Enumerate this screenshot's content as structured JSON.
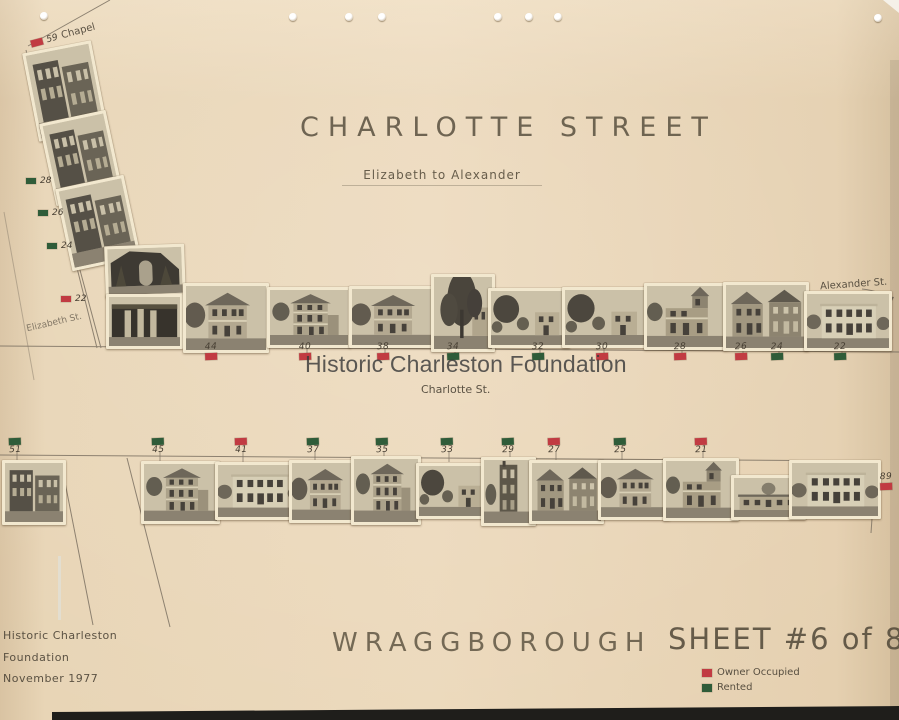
{
  "document": {
    "kind": "scanned street survey sheet",
    "title": "CHARLOTTE STREET",
    "subtitle": "Elizabeth to Alexander",
    "watermark": "Historic Charleston Foundation",
    "street_caption": "Charlotte St.",
    "neighborhood": "WRAGGBOROUGH",
    "sheet_label": "SHEET #6 of 8"
  },
  "status_colors": {
    "owner": "#c13b42",
    "rented": "#2f5c39"
  },
  "corner_label": {
    "number": "59",
    "street": "Chapel",
    "status": "owner"
  },
  "side_streets": {
    "left": "Elizabeth St.",
    "right": "Alexander St."
  },
  "left_strip_markers": [
    {
      "number": "28",
      "status": "rented"
    },
    {
      "number": "26",
      "status": "rented"
    },
    {
      "number": "24",
      "status": "rented"
    },
    {
      "number": "22",
      "status": "owner"
    }
  ],
  "top_row": [
    {
      "number": "44",
      "status": "owner"
    },
    {
      "number": "40",
      "status": "owner"
    },
    {
      "number": "38",
      "status": "owner"
    },
    {
      "number": "34",
      "status": "rented"
    },
    {
      "number": "32",
      "status": "rented"
    },
    {
      "number": "30",
      "status": "owner"
    },
    {
      "number": "28",
      "status": "owner"
    },
    {
      "number": "26",
      "status": "owner"
    },
    {
      "number": "24",
      "status": "rented"
    },
    {
      "number": "22",
      "status": "rented"
    }
  ],
  "bottom_row": [
    {
      "number": "51",
      "status": "rented"
    },
    {
      "number": "45",
      "status": "rented"
    },
    {
      "number": "41",
      "status": "owner"
    },
    {
      "number": "37",
      "status": "rented"
    },
    {
      "number": "35",
      "status": "rented"
    },
    {
      "number": "33",
      "status": "rented"
    },
    {
      "number": "29",
      "status": "rented"
    },
    {
      "number": "27",
      "status": "owner"
    },
    {
      "number": "25",
      "status": "rented"
    },
    {
      "number": "21",
      "status": "owner"
    }
  ],
  "right_edge_marker": {
    "number": "89",
    "status": "owner"
  },
  "footer": {
    "org_line1": "Historic Charleston",
    "org_line2": "Foundation",
    "org_line3": "November 1977",
    "legend": [
      {
        "label": "Owner Occupied",
        "status": "owner"
      },
      {
        "label": "Rented",
        "status": "rented"
      }
    ]
  }
}
